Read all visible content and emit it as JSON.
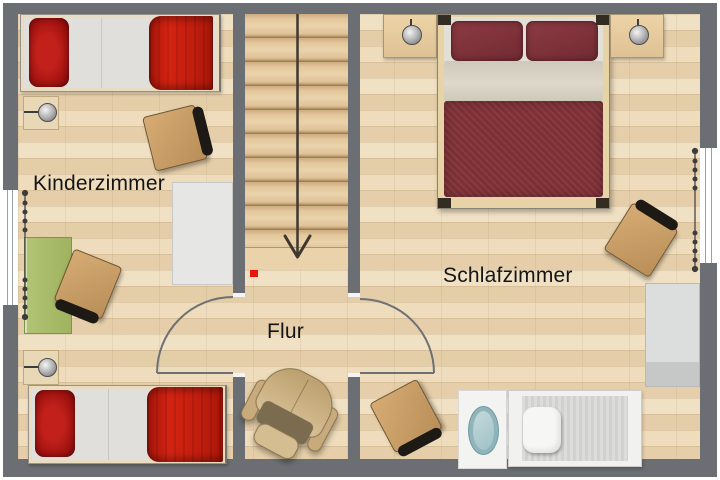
{
  "rooms": {
    "kinderzimmer": {
      "label": "Kinderzimmer",
      "furniture": [
        "single-bed-top",
        "single-bed-bottom",
        "wall-lamp-top",
        "wall-lamp-bottom",
        "desk-chair-top",
        "desk-chair-bottom",
        "green-desk",
        "white-cabinet"
      ]
    },
    "flur": {
      "label": "Flur",
      "furniture": [
        "staircase-down",
        "armchair"
      ],
      "annotations": [
        "stair-direction-arrow",
        "red-marker"
      ]
    },
    "schlafzimmer": {
      "label": "Schlafzimmer",
      "furniture": [
        "double-bed",
        "nightstand-left",
        "nightstand-right",
        "bedside-lamp-left",
        "bedside-lamp-right",
        "desk-chair-upper-right",
        "desk-chair-lower-left",
        "wardrobe",
        "oval-basin-on-mat",
        "daybed-with-cushion"
      ]
    }
  },
  "openings": {
    "windows": [
      "left-wall-window",
      "right-wall-window"
    ],
    "doors": [
      "kinderzimmer-door",
      "schlafzimmer-door"
    ],
    "curtains": [
      "left-window-curtain",
      "right-window-curtain"
    ]
  },
  "colors": {
    "wall": "#6b6e72",
    "floor": "#ecd8b4",
    "stairs_wood": "#ddbe92",
    "blanket_red": "#c01d0e",
    "pillow_dark_red": "#a01210",
    "double_bed_maroon": "#7d3036",
    "duvet_fold_cream": "#d8d2c4",
    "mattress_white": "#e0dfdc",
    "desk_green": "#a9bd6b",
    "chair_wood": "#c89b62",
    "chair_back": "#1d1915",
    "armchair_beige": "#cfb286",
    "wardrobe_gray": "#dcdddd",
    "basin_teal": "#8fb5ba",
    "marker_red": "#e8150a",
    "lamp_silver": "#b9b9b9"
  }
}
